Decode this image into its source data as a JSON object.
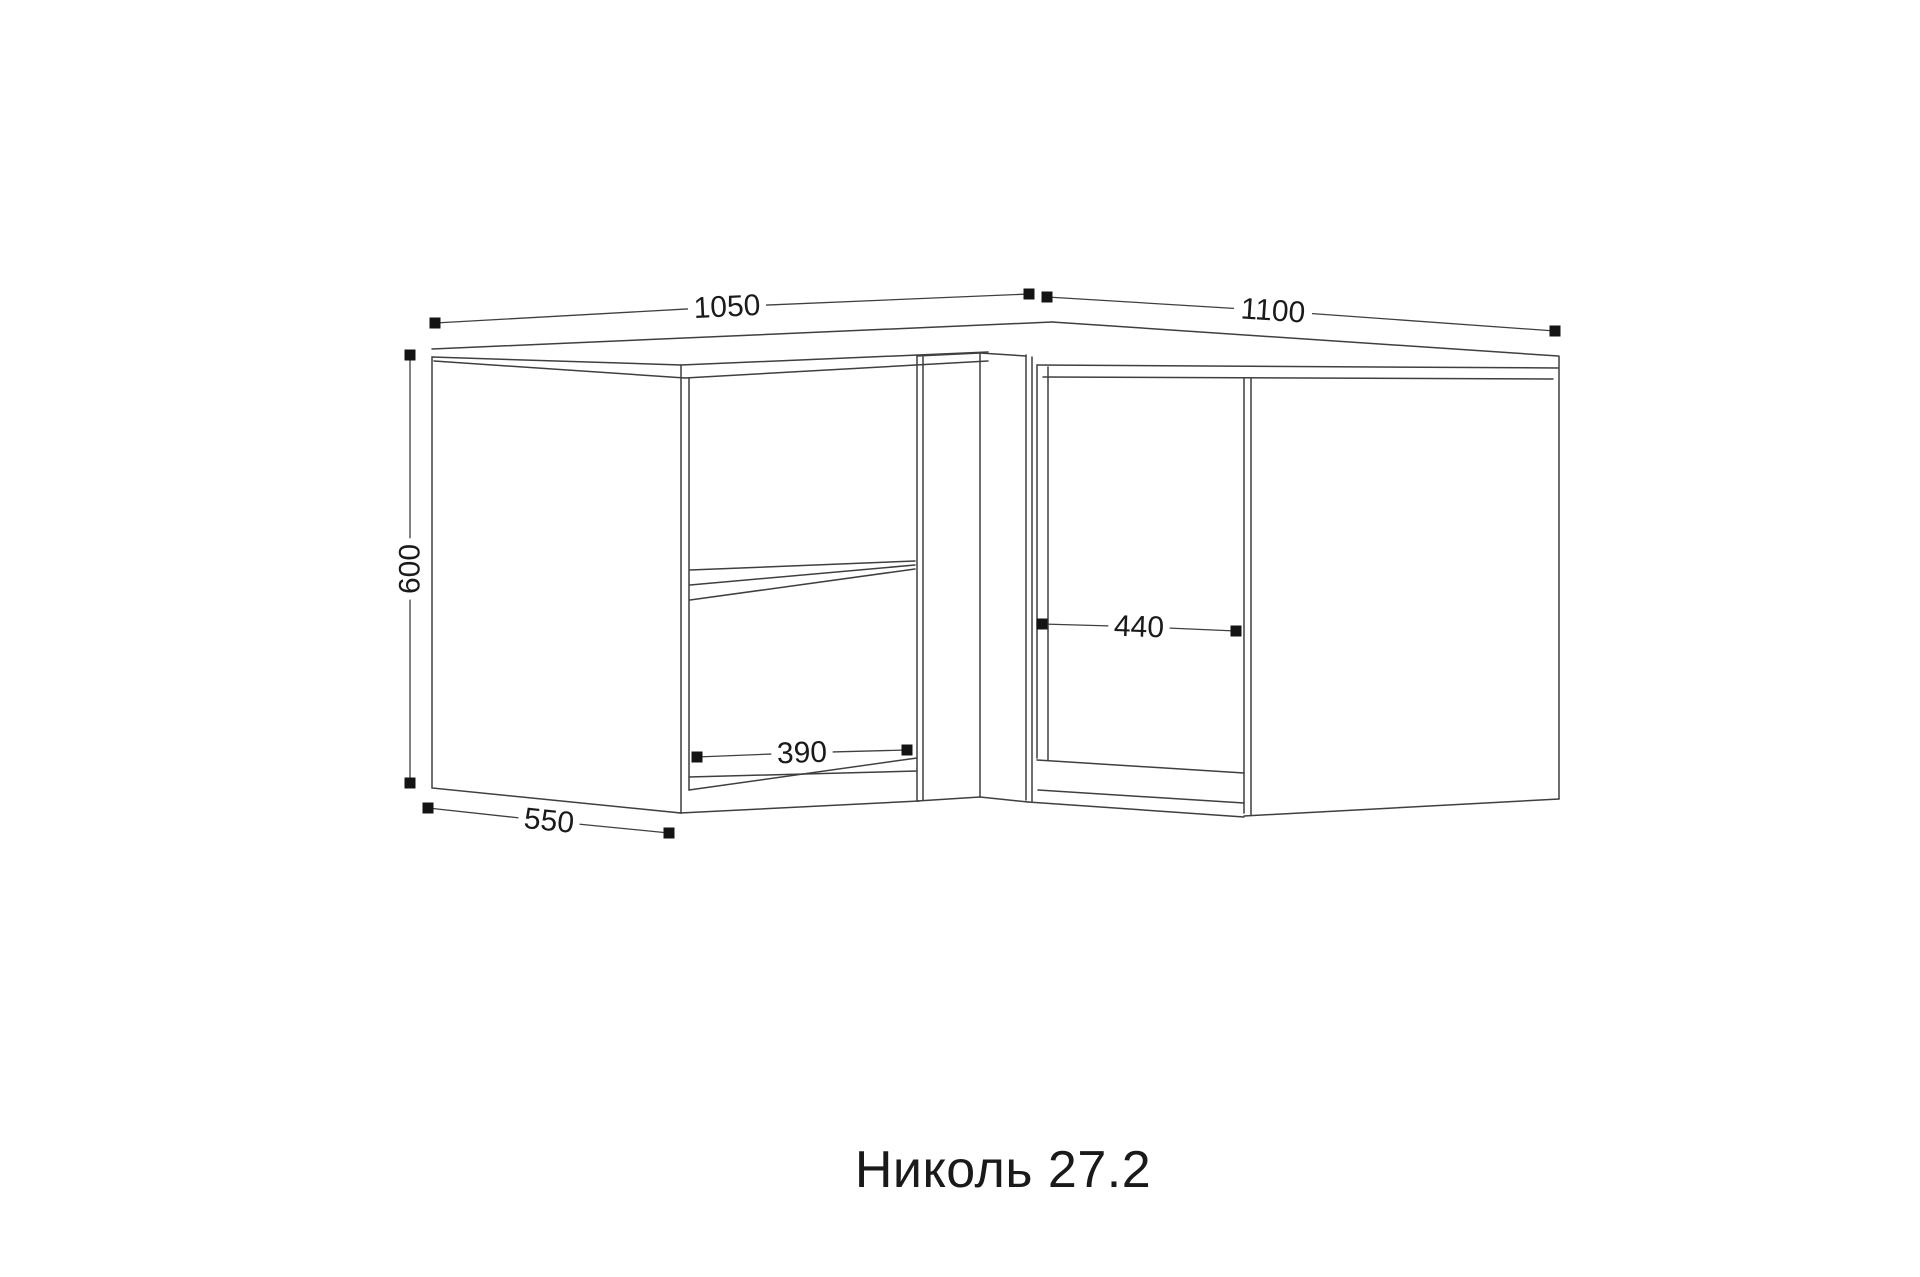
{
  "title": "Николь 27.2",
  "drawing": {
    "background_color": "#ffffff",
    "line_color": "#3f3f3f",
    "marker_color": "#141414",
    "dim_text_color": "#1a1a1a",
    "dim_font_size": 30,
    "marker_size": 11,
    "dims": [
      {
        "id": "top-width-left",
        "label": "1050",
        "x1": 435,
        "y1": 323,
        "x2": 1029,
        "y2": 294,
        "lx": 727,
        "ly": 307,
        "angle": -2.8
      },
      {
        "id": "top-width-right",
        "label": "1100",
        "x1": 1047,
        "y1": 297,
        "x2": 1555,
        "y2": 331,
        "lx": 1273,
        "ly": 311,
        "angle": 3.8
      },
      {
        "id": "height",
        "label": "600",
        "x1": 410,
        "y1": 355,
        "x2": 410,
        "y2": 783,
        "lx": 410,
        "ly": 569,
        "angle": -90
      },
      {
        "id": "depth",
        "label": "550",
        "x1": 428,
        "y1": 808,
        "x2": 669,
        "y2": 833,
        "lx": 549,
        "ly": 821,
        "angle": 5.9
      },
      {
        "id": "opening-left-width",
        "label": "390",
        "x1": 697,
        "y1": 757,
        "x2": 907,
        "y2": 750,
        "lx": 802,
        "ly": 753,
        "angle": -1.9
      },
      {
        "id": "opening-right-width",
        "label": "440",
        "x1": 1042,
        "y1": 624,
        "x2": 1236,
        "y2": 631,
        "lx": 1139,
        "ly": 627,
        "angle": 2.1
      }
    ]
  }
}
